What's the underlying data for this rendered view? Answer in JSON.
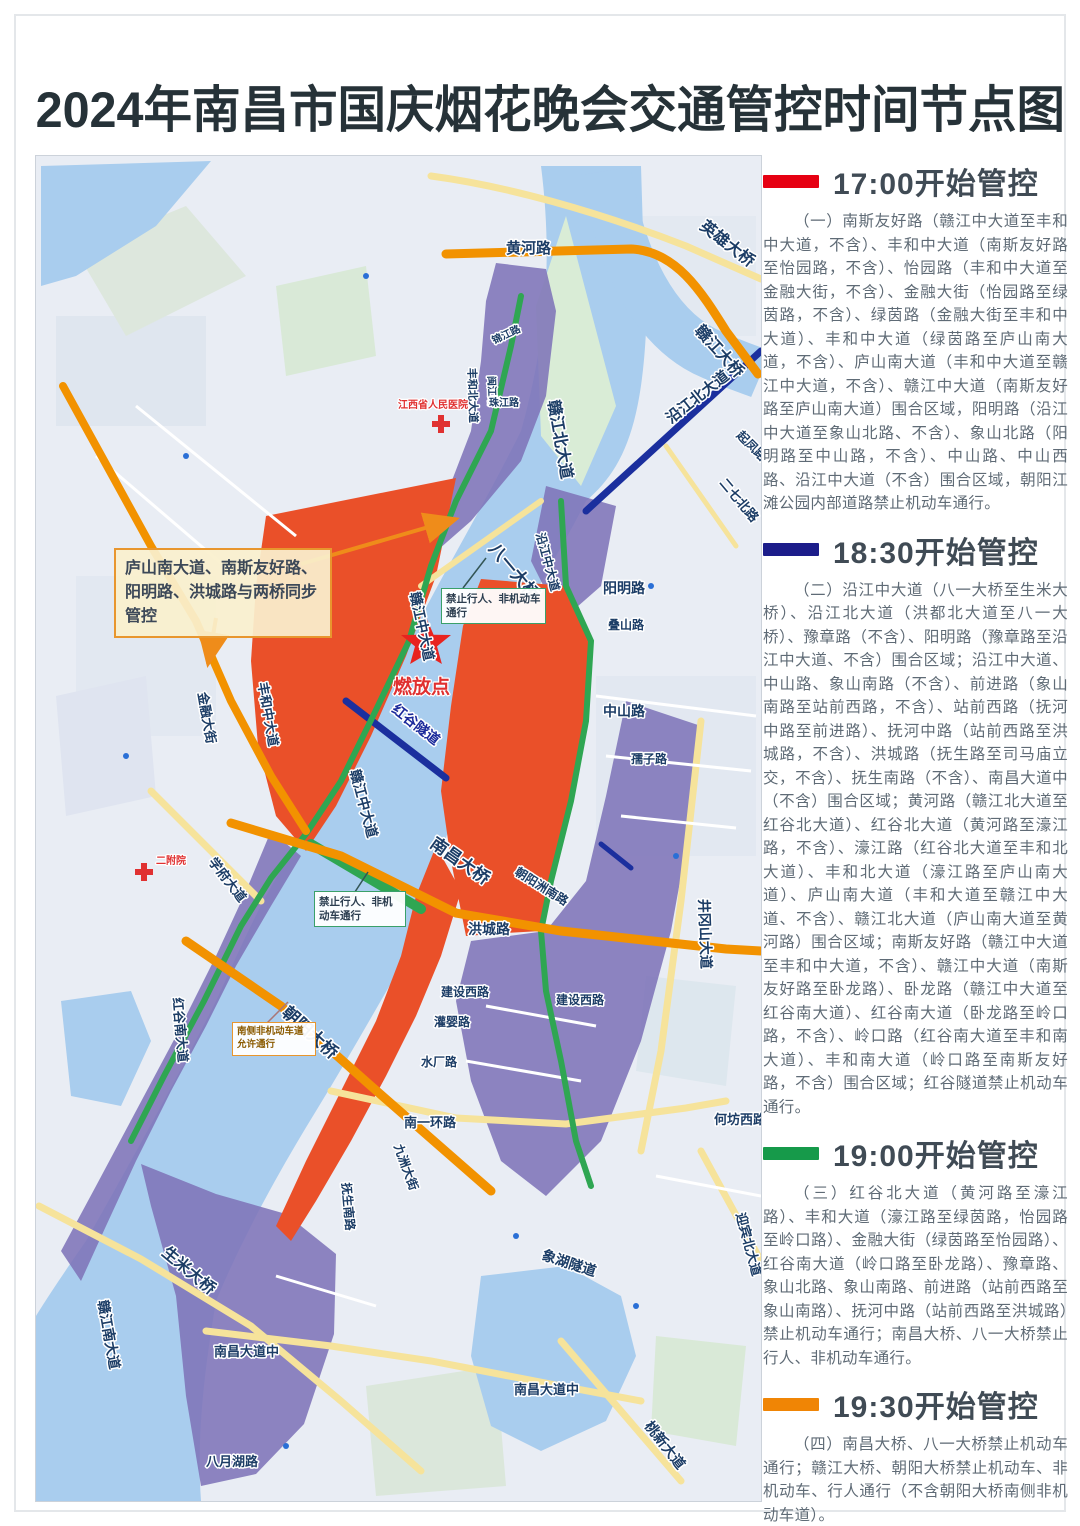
{
  "title": "2024年南昌市国庆烟花晚会交通管控时间节点图",
  "legend_sections": [
    {
      "time": "17:00开始管控",
      "color": "#e60012",
      "body": "（一）南斯友好路（赣江中大道至丰和中大道，不含）、丰和中大道（南斯友好路至怡园路，不含）、怡园路（丰和中大道至金融大街，不含）、金融大街（怡园路至绿茵路，不含）、绿茵路（金融大街至丰和中大道）、丰和中大道（绿茵路至庐山南大道，不含）、庐山南大道（丰和中大道至赣江中大道，不含）、赣江中大道（南斯友好路至庐山南大道）围合区域，阳明路（沿江中大道至象山北路、不含）、象山北路（阳明路至中山路，不含）、中山路、中山西路、沿江中大道（不含）围合区域，朝阳江滩公园内部道路禁止机动车通行。"
    },
    {
      "time": "18:30开始管控",
      "color": "#1c1d8a",
      "body": "（二）沿江中大道（八一大桥至生米大桥）、沿江北大道（洪都北大道至八一大桥）、豫章路（不含）、阳明路（豫章路至沿江中大道、不含）围合区域；沿江中大道、中山路、象山南路（不含）、前进路（象山南路至站前西路，不含）、站前西路（抚河中路至前进路）、抚河中路（站前西路至洪城路，不含）、洪城路（抚生路至司马庙立交，不含）、抚生南路（不含）、南昌大道中（不含）围合区域；黄河路（赣江北大道至红谷北大道）、红谷北大道（黄河路至濠江路，不含）、濠江路（红谷北大道至丰和北大道）、丰和北大道（濠江路至庐山南大道）、庐山南大道（丰和大道至赣江中大道、不含）、赣江北大道（庐山南大道至黄河路）围合区域；南斯友好路（赣江中大道至丰和中大道，不含）、赣江中大道（南斯友好路至卧龙路）、卧龙路（赣江中大道至红谷南大道）、红谷南大道（卧龙路至岭口路，不含）、岭口路（红谷南大道至丰和南大道）、丰和南大道（岭口路至南斯友好路，不含）围合区域；红谷隧道禁止机动车通行。"
    },
    {
      "time": "19:00开始管控",
      "color": "#169a4a",
      "body": "（三）红谷北大道（黄河路至濠江路）、丰和大道（濠江路至绿茵路，怡园路至岭口路）、金融大街（绿茵路至怡园路）、红谷南大道（岭口路至卧龙路）、豫章路、象山北路、象山南路、前进路（站前西路至象山南路）、抚河中路（站前西路至洪城路）禁止机动车通行；南昌大桥、八一大桥禁止行人、非机动车通行。"
    },
    {
      "time": "19:30开始管控",
      "color": "#f08505",
      "body": "（四）南昌大桥、八一大桥禁止机动车通行；赣江大桥、朝阳大桥禁止机动车、非机动车、行人通行（不含朝阳大桥南侧非机动车道）。"
    }
  ],
  "map": {
    "launch_point": "燃放点",
    "callouts": {
      "sync_note": "庐山南大道、南斯友好路、阳明路、洪城路与两桥同步管控",
      "bayi_bridge_ban": "禁止行人、非机动车通行",
      "nanchang_bridge_ban": "禁止行人、非机动车通行",
      "chaoyang_bridge_note": "南侧非机动车道允许通行"
    },
    "zone_colors": {
      "red_zone": "#ea5029",
      "purple_zone": "#7e74b8",
      "green_road": "#2fa652",
      "orange_road": "#f29200",
      "navy_road": "#1b2f9e",
      "water": "#a9cdee"
    },
    "labels": [
      {
        "text": "黄河路"
      },
      {
        "text": "英雄大桥"
      },
      {
        "text": "赣江大桥"
      },
      {
        "text": "沿江北大道"
      },
      {
        "text": "起凤路"
      },
      {
        "text": "赣江北大道"
      },
      {
        "text": "丰和北大道"
      },
      {
        "text": "锦江路"
      },
      {
        "text": "闽江路"
      },
      {
        "text": "珠江路"
      },
      {
        "text": "江西省人民医院"
      },
      {
        "text": "二附院"
      },
      {
        "text": "二七北路"
      },
      {
        "text": "八一大桥"
      },
      {
        "text": "阳明路"
      },
      {
        "text": "叠山路"
      },
      {
        "text": "赣江中大道"
      },
      {
        "text": "燃放点"
      },
      {
        "text": "中山路"
      },
      {
        "text": "孺子路"
      },
      {
        "text": "红谷隧道"
      },
      {
        "text": "赣江中大道"
      },
      {
        "text": "南昌大桥"
      },
      {
        "text": "朝阳洲南路"
      },
      {
        "text": "洪城路"
      },
      {
        "text": "井冈山大道"
      },
      {
        "text": "建设西路"
      },
      {
        "text": "建设西路"
      },
      {
        "text": "灌婴路"
      },
      {
        "text": "朝阳大桥"
      },
      {
        "text": "水厂路"
      },
      {
        "text": "南一环路"
      },
      {
        "text": "何坊西路"
      },
      {
        "text": "九洲大街"
      },
      {
        "text": "抚生南路"
      },
      {
        "text": "迎宾北大道"
      },
      {
        "text": "象湖隧道"
      },
      {
        "text": "生米大桥"
      },
      {
        "text": "赣江南大道"
      },
      {
        "text": "南昌大道中"
      },
      {
        "text": "南昌大道中"
      },
      {
        "text": "桃新大道"
      },
      {
        "text": "八月湖路"
      },
      {
        "text": "学府大道"
      },
      {
        "text": "红谷南大道"
      },
      {
        "text": "金融大街"
      },
      {
        "text": "丰和中大道"
      },
      {
        "text": "沿江中大道"
      }
    ]
  }
}
